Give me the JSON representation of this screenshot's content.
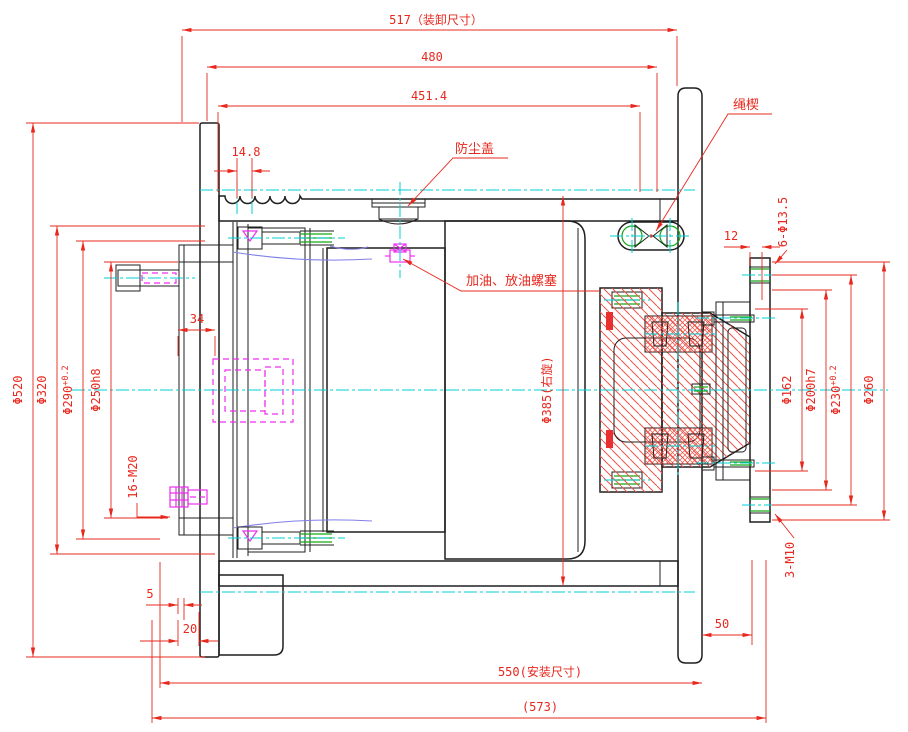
{
  "colors": {
    "outline": "#1f1f1f",
    "dimension_red": "#e8281e",
    "hatch_red": "#ef5449",
    "centerline_cyan": "#00cfd6",
    "hidden_magenta": "#ee2fee",
    "thread_green": "#18a818",
    "gear_arc_blue": "#8080e8",
    "background": "#ffffff"
  },
  "dimensions": {
    "top": {
      "d517": "517（装卸尺寸）",
      "d480": "480",
      "d4514": "451.4",
      "d148": "14.8"
    },
    "left": {
      "d520": "Φ520",
      "d320": "Φ320",
      "d290": {
        "base": "Φ290",
        "tol": "+0.2"
      },
      "d250": "Φ250h8",
      "d16m20": "16-M20",
      "d34": "34"
    },
    "center": {
      "d385": "Φ385(右旋)"
    },
    "right": {
      "d6": "6-Φ13.5",
      "d12": "12",
      "d162": "Φ162",
      "d200": "Φ200h7",
      "d230": {
        "base": "Φ230",
        "tol": "+0.2"
      },
      "d260": "Φ260",
      "d3m10": "3-M10"
    },
    "bottom": {
      "d5": "5",
      "d20": "20",
      "d50": "50",
      "d550": "550(安装尺寸)",
      "d573": "(573)"
    }
  },
  "callouts": {
    "dust_cover": "防尘盖",
    "rope_wedge": "绳楔",
    "oil_plug": "加油、放油螺塞"
  }
}
